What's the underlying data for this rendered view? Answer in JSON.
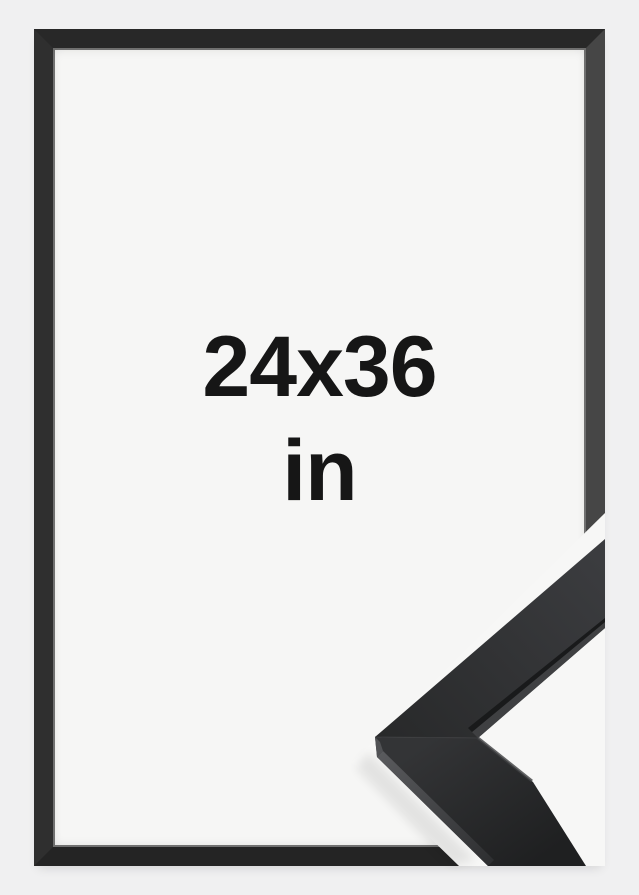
{
  "product_image": {
    "label": {
      "dimensions": "24x36",
      "unit": "in"
    }
  },
  "colors": {
    "page_background": "#f0f0f1",
    "inner_background": "#f6f6f5",
    "frame_top": "#282828",
    "frame_left": "#2f2f2f",
    "frame_right": "#464646",
    "frame_bottom": "#242424",
    "label_text": "#161616",
    "sample_background": "#f7f7f6",
    "sample_rail_dark": "#232425",
    "sample_rail_light": "#3b3c3f",
    "sample_edge_highlight": "#5b5c5f"
  }
}
